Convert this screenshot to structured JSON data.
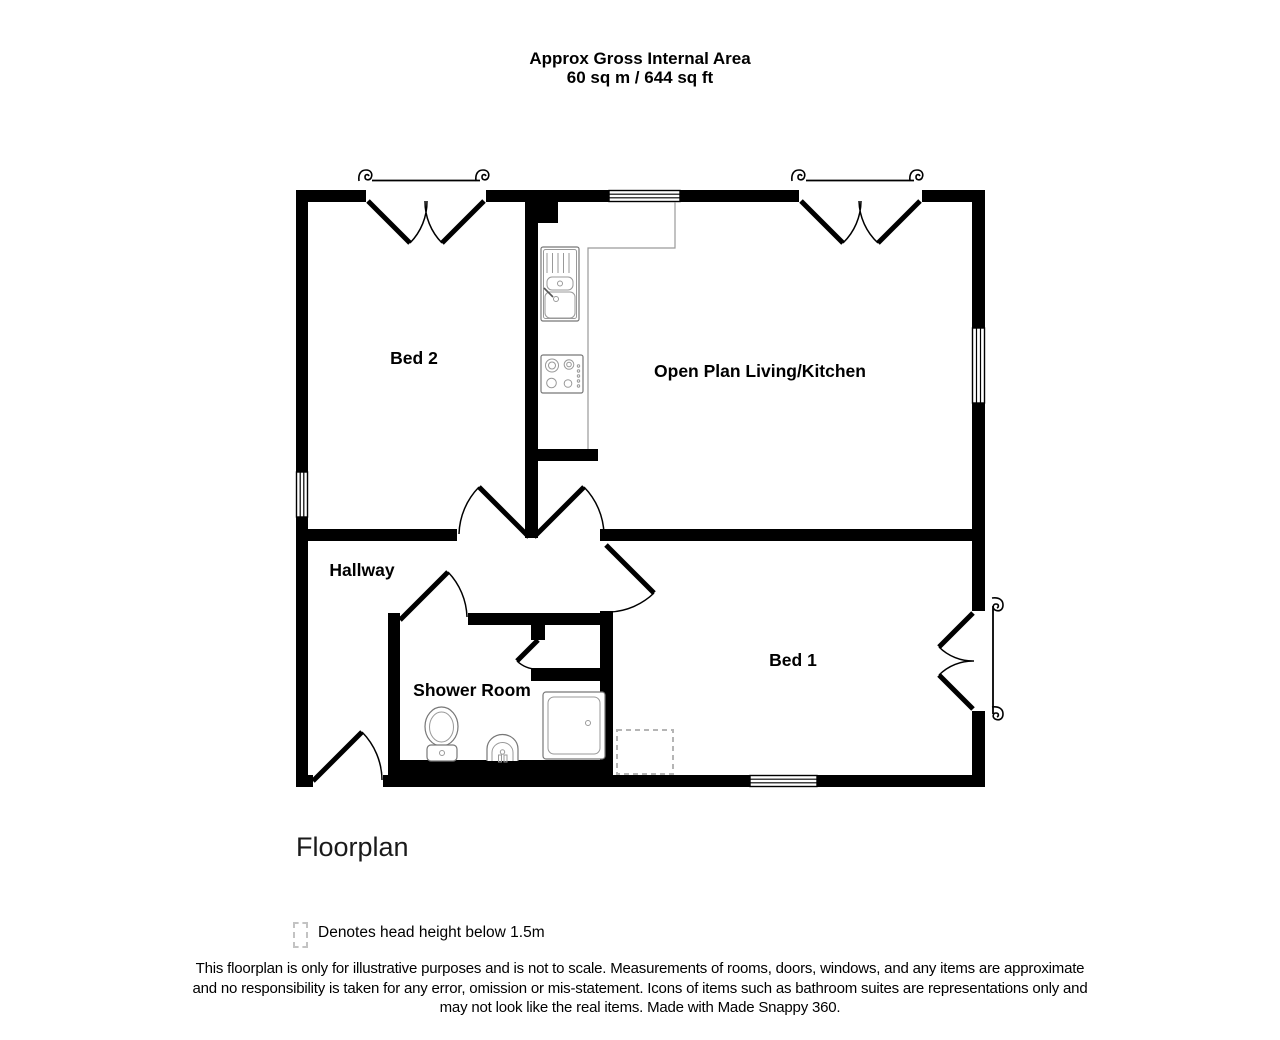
{
  "header": {
    "line1": "Approx Gross Internal Area",
    "line2": "60 sq m / 644 sq ft"
  },
  "rooms": [
    {
      "name": "Bed 2"
    },
    {
      "name": "Open Plan Living/Kitchen"
    },
    {
      "name": "Hallway"
    },
    {
      "name": "Shower Room"
    },
    {
      "name": "Bed 1"
    }
  ],
  "fixtures": [
    "kitchen-sink",
    "hob",
    "toilet",
    "basin",
    "shower-tray"
  ],
  "footer": {
    "plan_label": "Floorplan",
    "legend": "Denotes head height below 1.5m",
    "disclaimer1": "This floorplan is only for illustrative purposes and is not to scale. Measurements of rooms, doors, windows, and any items are approximate",
    "disclaimer2": "and no responsibility is taken for any error, omission or mis-statement. Icons of items such as bathroom suites are representations only and",
    "disclaimer3": "may not look like the real items. Made with Made Snappy 360."
  },
  "colors": {
    "wall": "#000000",
    "fixture_outline": "#777777",
    "counter_outline": "#9a9a9a",
    "dashed_area": "#b5b5b5"
  }
}
